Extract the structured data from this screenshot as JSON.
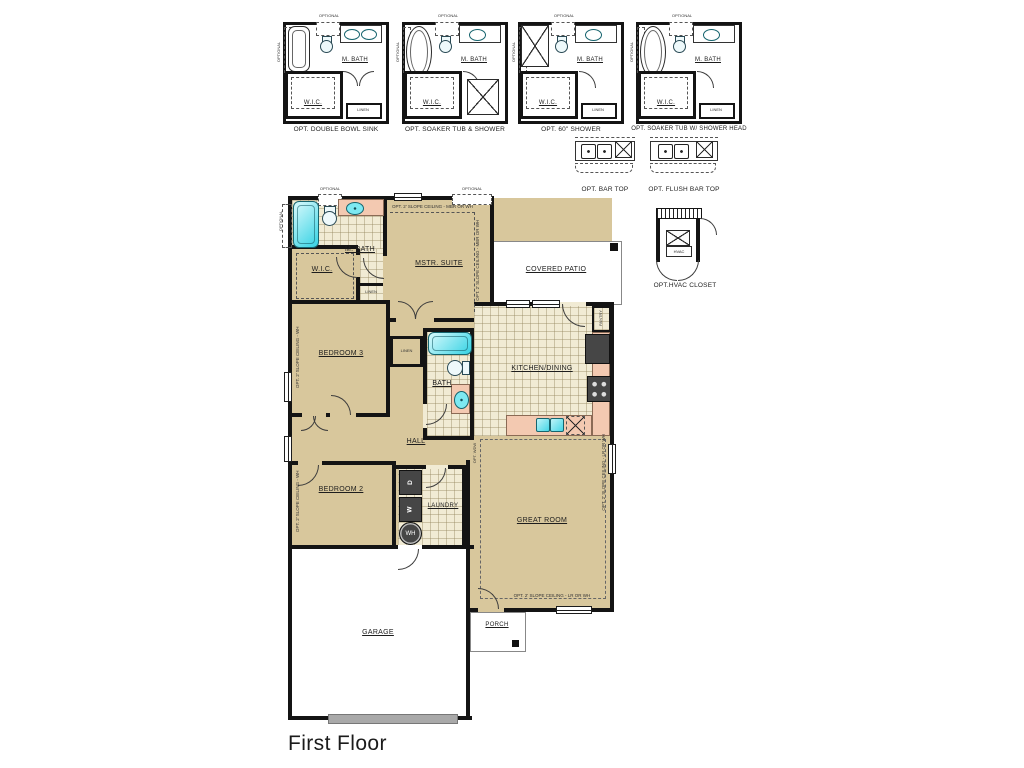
{
  "title": "First Floor",
  "bath_options": [
    {
      "label": "OPT. DOUBLE BOWL SINK"
    },
    {
      "label": "OPT. SOAKER TUB & SHOWER"
    },
    {
      "label": "OPT. 60\" SHOWER"
    },
    {
      "label": "OPT. SOAKER TUB W/ SHOWER HEAD"
    }
  ],
  "bar_options": [
    {
      "label": "OPT. BAR TOP"
    },
    {
      "label": "OPT. FLUSH BAR TOP"
    }
  ],
  "hvac": {
    "label": "OPT.HVAC CLOSET",
    "unit": "HVAC"
  },
  "rooms": {
    "m_bath": "M. BATH",
    "wic": "W.I.C.",
    "linen": "LINEN",
    "mstr_suite": "MSTR. SUITE",
    "covered_patio": "COVERED PATIO",
    "kitchen_dining": "KITCHEN/DINING",
    "pantry": "PANTRY",
    "bedroom3": "BEDROOM 3",
    "bedroom2": "BEDROOM 2",
    "bath": "BATH",
    "hall": "HALL",
    "laundry": "LAUNDRY",
    "great_room": "GREAT ROOM",
    "garage": "GARAGE",
    "porch": "PORCH"
  },
  "fixtures": {
    "washer": "W",
    "dryer": "D",
    "water_heater": "WH"
  },
  "notes": {
    "optional": "OPTIONAL",
    "slope_mbr": "OPT. 2' SLOPE CEILING - MBR OR WH",
    "slope_wh": "OPT. 2' SLOPE CEILING - WH",
    "slope_lr": "OPT. 2' SLOPE CEILING - LR OR WH",
    "opt_wdw": "OPT. WDW"
  },
  "colors": {
    "tan": "#d8c79c",
    "tile": "#f1ebd4",
    "cyan": "#45d6e6",
    "pink": "#f3c9b1",
    "appliance": "#464646",
    "wall": "#141414"
  }
}
